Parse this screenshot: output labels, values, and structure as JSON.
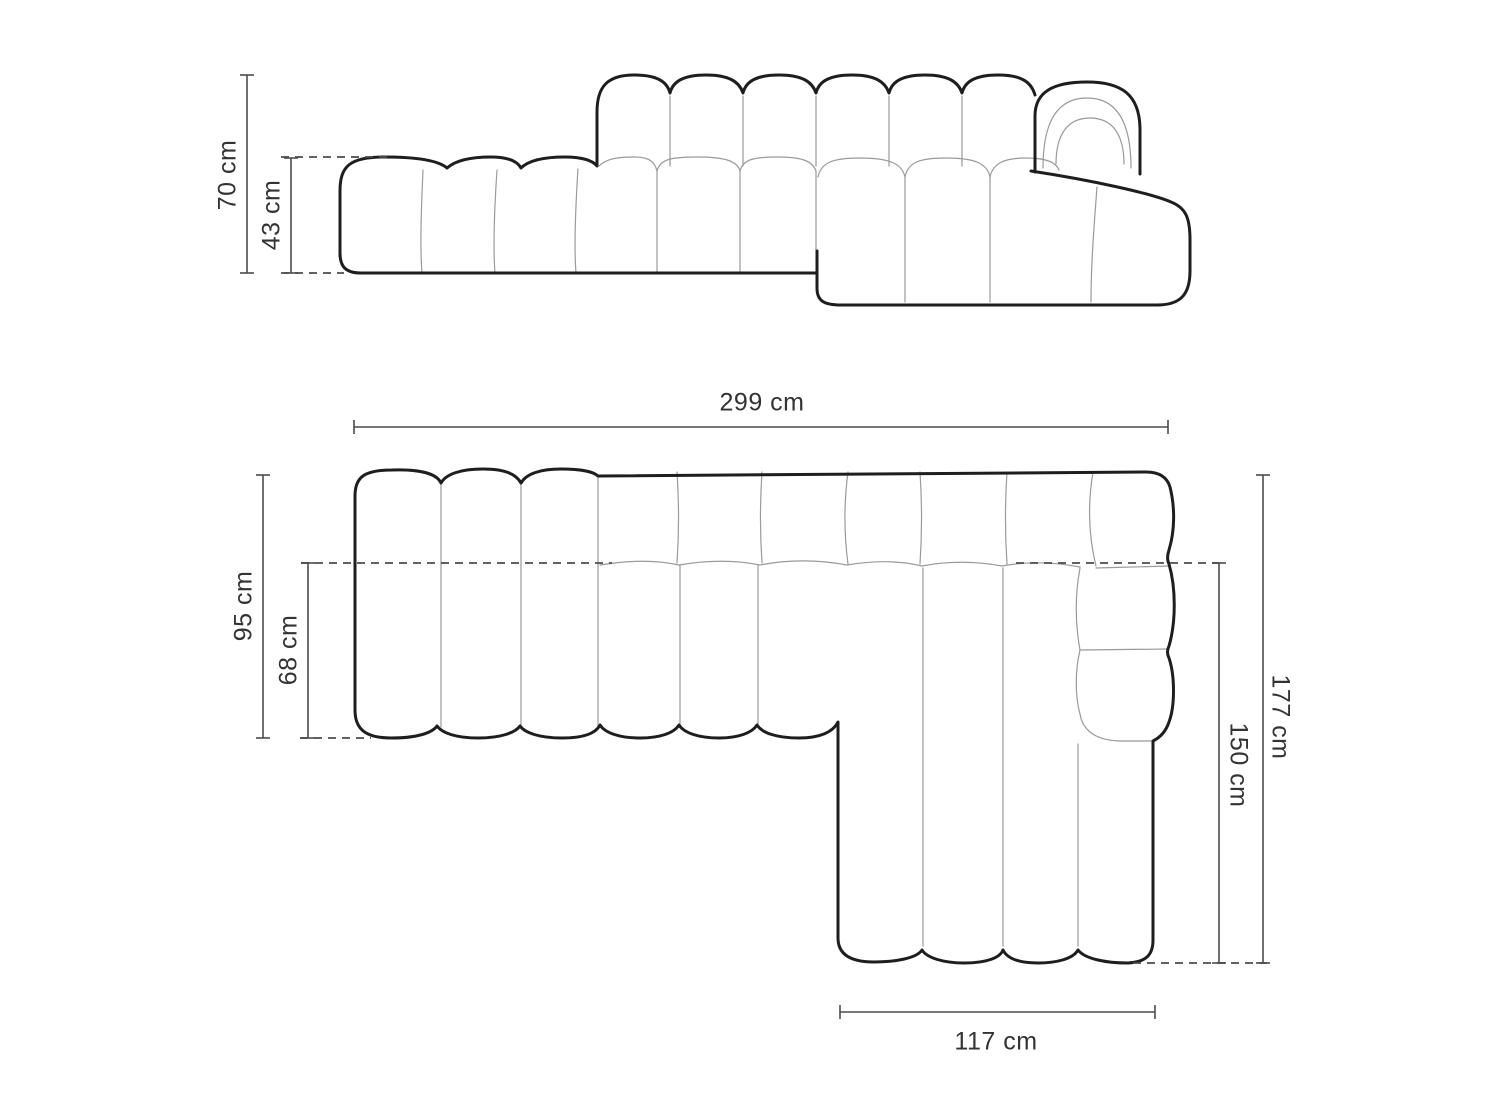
{
  "colors": {
    "background": "#ffffff",
    "outline": "#1e1e1e",
    "seam": "#9a9a9a",
    "dimension": "#4c4c4c",
    "label_text": "#333333"
  },
  "front_view": {
    "dimensions": {
      "total_height": {
        "label": "70 cm"
      },
      "seat_height": {
        "label": "43 cm"
      }
    }
  },
  "top_view": {
    "dimensions": {
      "total_width": {
        "label": "299 cm"
      },
      "left_depth": {
        "label": "95 cm"
      },
      "seat_depth": {
        "label": "68 cm"
      },
      "right_total_depth": {
        "label": "177 cm"
      },
      "chaise_depth": {
        "label": "150 cm"
      },
      "chaise_width": {
        "label": "117 cm"
      }
    }
  }
}
